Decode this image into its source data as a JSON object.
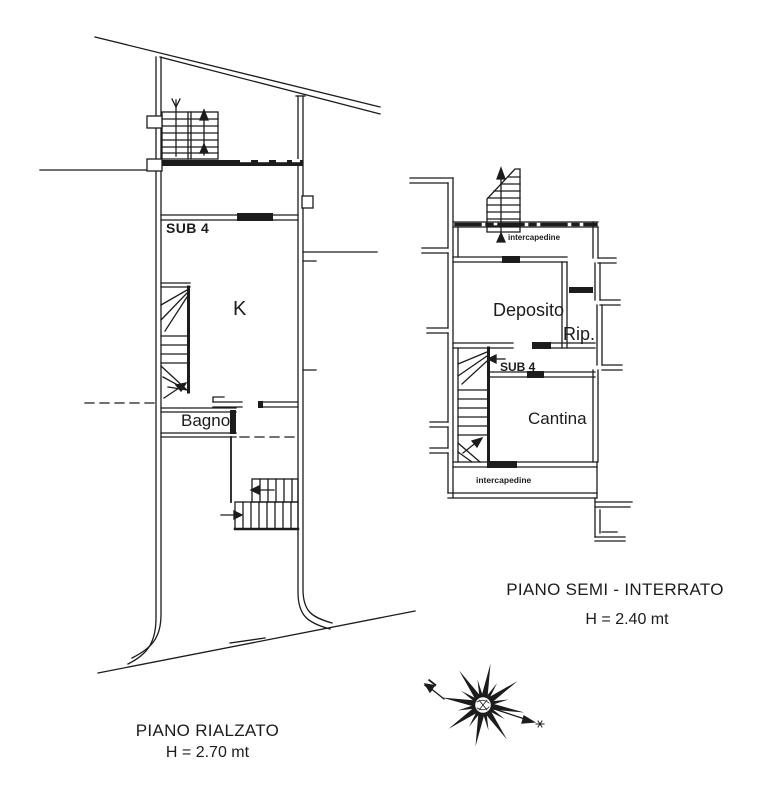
{
  "colors": {
    "ink": "#1c1c1c",
    "paper": "#ffffff"
  },
  "plans": {
    "rialzato": {
      "title": "PIANO RIALZATO",
      "height_label": "H = 2.70 mt",
      "labels": {
        "sub_unit": "SUB 4",
        "kitchen": "K",
        "bathroom": "Bagno"
      }
    },
    "seminterrato": {
      "title": "PIANO SEMI - INTERRATO",
      "height_label": "H = 2.40 mt",
      "labels": {
        "intercapedine_top": "intercapedine",
        "deposito": "Deposito",
        "ripostiglio": "Rip.",
        "sub_unit": "SUB 4",
        "cantina": "Cantina",
        "intercapedine_bottom": "intercapedine"
      }
    }
  },
  "compass": {
    "north_label": "N"
  }
}
